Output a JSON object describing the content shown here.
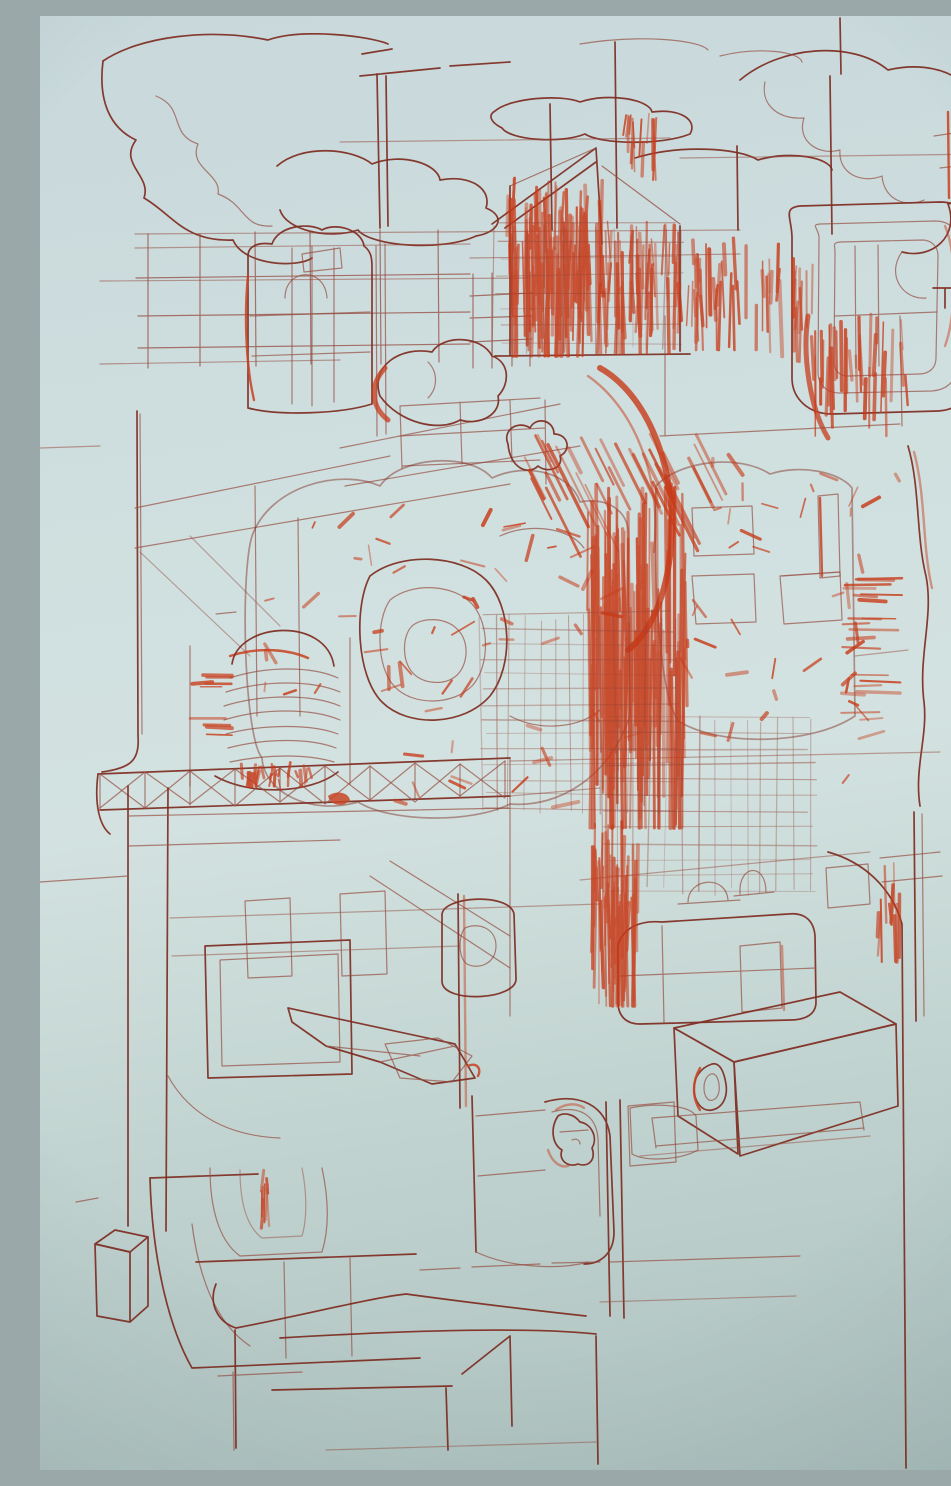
{
  "artwork": {
    "alt": "Photograph of an abstract red ink line drawing on pale blue paper: stacked machine-like and building forms, dense scribbled hatching in the centre, loopy clouds across the top and sparse boxy outlines toward the bottom."
  },
  "colors": {
    "paper_top": "#c8d8db",
    "paper_mid": "#d3e2e0",
    "paper_bottom": "#adc1be",
    "ink": "#7e2c21",
    "ink_soft": "#93463a",
    "ink_bright": "#c73a18"
  }
}
